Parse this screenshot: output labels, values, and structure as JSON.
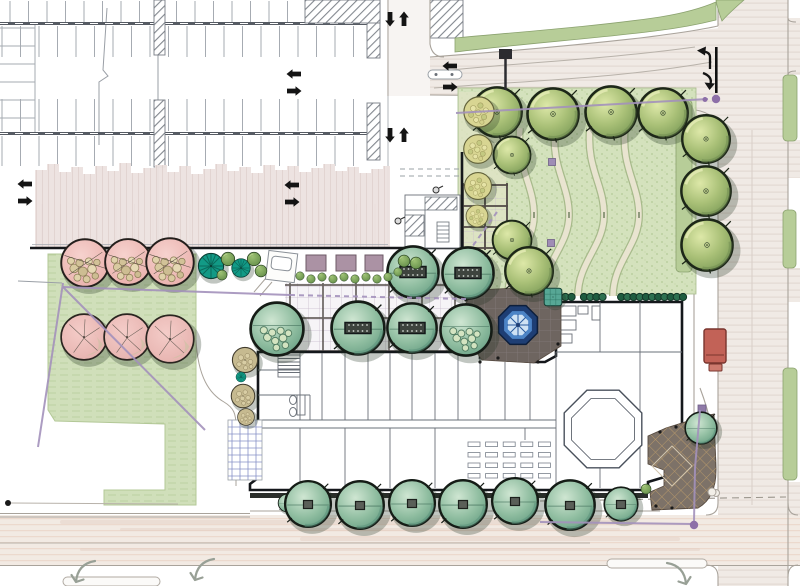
{
  "title": "Campus landscape site plan rendering",
  "colors": {
    "paper": "#ffffff",
    "road_base": "#f0eae5",
    "road_stroke": "#e3d9d2",
    "road_pink_base": "#f2eae3",
    "road_pink_stroke": "#ecd9cd",
    "curb": "#a9a39b",
    "lane": "#b8b2aa",
    "parking_tick": "#a6abb2",
    "parking_tick_light": "#c3b4b6",
    "aisle_bar": "#565b63",
    "hatch_line": "#82878e",
    "pink_band": "#ece1df",
    "pink_band_stroke": "#e0d2cf",
    "lawn_ne": "#d4e2bd",
    "lawn_stipple": "#b4ca97",
    "lawn_left": "#d0dfba",
    "grass_strip": "#b7cd98",
    "grass_edge": "#8ba26f",
    "path_fill": "#e9e4d0",
    "path_edge": "#a7ba8b",
    "hedge_dark": "#1f5c40",
    "hedge_mid": "#2d7050",
    "plaza_dark": "#6e6560",
    "entry_plaza": "#7d7268",
    "entry_hatch": "#c8a46c",
    "fountain_ring": "#1e3e74",
    "fountain_mid": "#4c84c6",
    "fountain_inner": "#cfe2f4",
    "building_wall_heavy": "#14171b",
    "building_wall": "#6a7078",
    "boundary_black": "#17191c",
    "purple": "#a391bb",
    "purple_dot": "#8d6fa8",
    "mauve_planter": "#ab92a4",
    "bus_red": "#c26257",
    "arrow_black": "#141414",
    "outline_arrow": "#98a096",
    "grid_lavender": "#c8bbcd",
    "pergola_beam": "#514a46",
    "trellis_blue": "#8892c8"
  },
  "parking": {
    "tick_rows": [
      {
        "x0": 10,
        "x1": 368,
        "y": 1,
        "h": 21,
        "gap": 18.5
      },
      {
        "x0": 2,
        "x1": 368,
        "y": 26,
        "h": 31,
        "gap": 18.5
      },
      {
        "x0": 2,
        "x1": 368,
        "y": 99,
        "h": 32,
        "gap": 18.5
      },
      {
        "x0": 2,
        "x1": 368,
        "y": 136,
        "h": 30,
        "gap": 18.5
      },
      {
        "x0": 42,
        "x1": 386,
        "y": 204,
        "h": 43,
        "gap": 18.5,
        "light": true
      }
    ],
    "htick": {
      "y0": 28,
      "y1": 118,
      "x": 0,
      "w": 35,
      "gap": 18
    },
    "aisle_bars": [
      23.5,
      133.5
    ],
    "hatch_islands": [
      [
        154,
        0,
        11,
        55
      ],
      [
        154,
        100,
        11,
        67
      ],
      [
        367,
        0,
        13,
        58
      ],
      [
        367,
        103,
        13,
        57
      ],
      [
        305,
        0,
        75,
        23
      ],
      [
        430,
        0,
        33,
        38
      ]
    ],
    "pink_band": {
      "x0": 35,
      "x1": 390,
      "y_bottom": 247,
      "step": 12,
      "tops": [
        170,
        164,
        172,
        167,
        174,
        166,
        171,
        163,
        173,
        168,
        165,
        172,
        166,
        174,
        169,
        164,
        171,
        167,
        173,
        165,
        170,
        166,
        172,
        168,
        164,
        171,
        167,
        173,
        169,
        166
      ]
    }
  },
  "landscape": {
    "trees": [
      {
        "t": "canopy",
        "x": 497,
        "y": 112,
        "r": 28
      },
      {
        "t": "canopy",
        "x": 553,
        "y": 114,
        "r": 29
      },
      {
        "t": "canopy",
        "x": 611,
        "y": 112,
        "r": 29
      },
      {
        "t": "canopy",
        "x": 663,
        "y": 113,
        "r": 28
      },
      {
        "t": "canopy",
        "x": 706,
        "y": 139,
        "r": 27
      },
      {
        "t": "canopy",
        "x": 706,
        "y": 191,
        "r": 28
      },
      {
        "t": "canopy",
        "x": 707,
        "y": 245,
        "r": 29
      },
      {
        "t": "canopy",
        "x": 512,
        "y": 155,
        "r": 21
      },
      {
        "t": "canopy",
        "x": 512,
        "y": 240,
        "r": 22
      },
      {
        "t": "yellowShrub",
        "x": 479,
        "y": 112,
        "r": 18
      },
      {
        "t": "yellowShrub",
        "x": 478,
        "y": 149,
        "r": 17
      },
      {
        "t": "yellowShrub",
        "x": 478,
        "y": 186,
        "r": 16
      },
      {
        "t": "yellowShrub",
        "x": 477,
        "y": 216,
        "r": 13
      },
      {
        "t": "sageShrub",
        "x": 277,
        "y": 329,
        "r": 30
      },
      {
        "t": "sageTable",
        "x": 358,
        "y": 328,
        "r": 30
      },
      {
        "t": "sageTable",
        "x": 413,
        "y": 272,
        "r": 29
      },
      {
        "t": "sageTable",
        "x": 468,
        "y": 273,
        "r": 29
      },
      {
        "t": "sageTable",
        "x": 412,
        "y": 328,
        "r": 28
      },
      {
        "t": "sageShrub",
        "x": 466,
        "y": 330,
        "r": 29
      },
      {
        "t": "canopy",
        "x": 529,
        "y": 271,
        "r": 27
      },
      {
        "t": "tealGrid",
        "x": 553,
        "y": 297,
        "r": 11
      },
      {
        "t": "oliveBubble",
        "x": 245,
        "y": 360,
        "r": 15
      },
      {
        "t": "oliveBubble",
        "x": 243,
        "y": 396,
        "r": 14
      },
      {
        "t": "oliveBubble",
        "x": 246,
        "y": 417,
        "r": 10
      },
      {
        "t": "tealFan",
        "x": 241,
        "y": 377,
        "r": 6
      },
      {
        "t": "pinkA",
        "x": 85,
        "y": 263,
        "r": 27
      },
      {
        "t": "pinkA",
        "x": 128,
        "y": 262,
        "r": 26
      },
      {
        "t": "pinkA",
        "x": 170,
        "y": 262,
        "r": 27
      },
      {
        "t": "pinkB",
        "x": 84,
        "y": 337,
        "r": 26
      },
      {
        "t": "pinkB",
        "x": 127,
        "y": 337,
        "r": 26
      },
      {
        "t": "pinkB",
        "x": 170,
        "y": 339,
        "r": 27
      },
      {
        "t": "tealFan",
        "x": 211,
        "y": 266,
        "r": 15
      },
      {
        "t": "greenBall",
        "x": 228,
        "y": 259,
        "r": 8
      },
      {
        "t": "tealFan",
        "x": 241,
        "y": 268,
        "r": 11
      },
      {
        "t": "greenBall",
        "x": 254,
        "y": 259,
        "r": 8
      },
      {
        "t": "greenBall",
        "x": 261,
        "y": 271,
        "r": 7
      },
      {
        "t": "greenBall",
        "x": 222,
        "y": 275,
        "r": 6
      },
      {
        "t": "greenBall",
        "x": 404,
        "y": 261,
        "r": 7
      },
      {
        "t": "greenBall",
        "x": 416,
        "y": 263,
        "r": 7
      },
      {
        "t": "greenBall",
        "x": 398,
        "y": 272,
        "r": 5
      },
      {
        "t": "greenBall",
        "x": 300,
        "y": 276,
        "r": 5
      },
      {
        "t": "greenBall",
        "x": 311,
        "y": 279,
        "r": 5
      },
      {
        "t": "greenBall",
        "x": 322,
        "y": 277,
        "r": 5
      },
      {
        "t": "greenBall",
        "x": 333,
        "y": 279,
        "r": 5
      },
      {
        "t": "greenBall",
        "x": 344,
        "y": 277,
        "r": 5
      },
      {
        "t": "greenBall",
        "x": 355,
        "y": 279,
        "r": 5
      },
      {
        "t": "greenBall",
        "x": 366,
        "y": 277,
        "r": 5
      },
      {
        "t": "greenBall",
        "x": 377,
        "y": 279,
        "r": 5
      },
      {
        "t": "greenBall",
        "x": 388,
        "y": 277,
        "r": 5
      },
      {
        "t": "sage",
        "x": 287,
        "y": 503,
        "r": 10
      },
      {
        "t": "sageSq",
        "x": 308,
        "y": 504,
        "r": 26
      },
      {
        "t": "sageSq",
        "x": 360,
        "y": 505,
        "r": 27
      },
      {
        "t": "sageSq",
        "x": 412,
        "y": 503,
        "r": 26
      },
      {
        "t": "sageSq",
        "x": 463,
        "y": 504,
        "r": 27
      },
      {
        "t": "sageSq",
        "x": 515,
        "y": 501,
        "r": 26
      },
      {
        "t": "sageSq",
        "x": 570,
        "y": 505,
        "r": 28
      },
      {
        "t": "sageSq",
        "x": 621,
        "y": 504,
        "r": 19
      },
      {
        "t": "greenBall",
        "x": 646,
        "y": 489,
        "r": 6
      },
      {
        "t": "sage",
        "x": 701,
        "y": 428,
        "r": 18
      }
    ],
    "hedge": {
      "x0": 553,
      "x1": 686,
      "y": 297,
      "bead_r": 3.6,
      "gap_at": [
        578,
        613
      ]
    },
    "lawn_paths": {
      "bottom_y": 296,
      "xs": [
        508,
        543,
        578,
        613
      ]
    },
    "lawn_squares": [
      [
        552,
        162
      ],
      [
        551,
        243
      ]
    ],
    "plaza_square": [
      698,
      405
    ],
    "planters": [
      [
        306,
        255,
        20,
        16
      ],
      [
        336,
        255,
        20,
        16
      ],
      [
        365,
        255,
        18,
        16
      ]
    ],
    "green_strips": [
      [
        676,
        100,
        16,
        172
      ],
      [
        783,
        75,
        14,
        66
      ],
      [
        783,
        210,
        13,
        58
      ],
      [
        783,
        368,
        14,
        112
      ]
    ]
  },
  "site": {
    "fountain": {
      "cx": 518,
      "cy": 325,
      "r_outer": 21,
      "r_mid": 15,
      "r_inner": 11
    },
    "bus": {
      "x": 704,
      "y": 329,
      "w": 22,
      "h": 34,
      "trailer": [
        709,
        364,
        13,
        7
      ]
    },
    "purple_lines": [
      {
        "pts": [
          [
            63,
            283
          ],
          [
            38,
            447
          ]
        ],
        "dash": false
      },
      {
        "pts": [
          [
            63,
            287
          ],
          [
            205,
            430
          ]
        ],
        "dash": false
      },
      {
        "pts": [
          [
            63,
            287
          ],
          [
            290,
            295
          ]
        ],
        "dash": false
      },
      {
        "pts": [
          [
            290,
            295
          ],
          [
            466,
            299
          ]
        ],
        "dash": true
      },
      {
        "pts": [
          [
            456,
            113
          ],
          [
            708,
            99
          ]
        ],
        "dash": false
      },
      {
        "pts": [
          [
            700,
            410
          ],
          [
            695,
            468
          ],
          [
            694,
            522
          ]
        ],
        "dash": false
      },
      {
        "pts": [
          [
            694,
            524
          ],
          [
            540,
            522
          ]
        ],
        "dash": false
      },
      {
        "pts": [
          [
            497,
            212
          ],
          [
            472,
            247
          ]
        ],
        "dash": true
      }
    ],
    "purple_dots": [
      [
        705,
        99.5,
        2.5
      ],
      [
        716,
        99,
        4.2
      ],
      [
        694,
        525,
        4.2
      ]
    ],
    "black_dot": [
      8,
      503
    ],
    "black_dot_line": [
      [
        11,
        503
      ],
      [
        178,
        504
      ]
    ]
  },
  "traffic": {
    "straight_arrows": [
      {
        "x": 25,
        "y": 184,
        "d": "l"
      },
      {
        "x": 25,
        "y": 201,
        "d": "r"
      },
      {
        "x": 294,
        "y": 74,
        "d": "l"
      },
      {
        "x": 294,
        "y": 91,
        "d": "r"
      },
      {
        "x": 292,
        "y": 185,
        "d": "l"
      },
      {
        "x": 292,
        "y": 202,
        "d": "r"
      },
      {
        "x": 450,
        "y": 66,
        "d": "l"
      },
      {
        "x": 450,
        "y": 87,
        "d": "r"
      },
      {
        "x": 390,
        "y": 19,
        "d": "dn"
      },
      {
        "x": 404,
        "y": 19,
        "d": "u"
      },
      {
        "x": 390,
        "y": 135,
        "d": "dn"
      },
      {
        "x": 404,
        "y": 135,
        "d": "u"
      }
    ],
    "outline_arrows": [
      {
        "x": 84,
        "y": 572,
        "flip": false
      },
      {
        "x": 203,
        "y": 570,
        "flip": false
      },
      {
        "x": 678,
        "y": 574,
        "flip": true
      }
    ],
    "lane_pills": [
      [
        607,
        559,
        100,
        9
      ],
      [
        63,
        577,
        97,
        9
      ]
    ]
  }
}
